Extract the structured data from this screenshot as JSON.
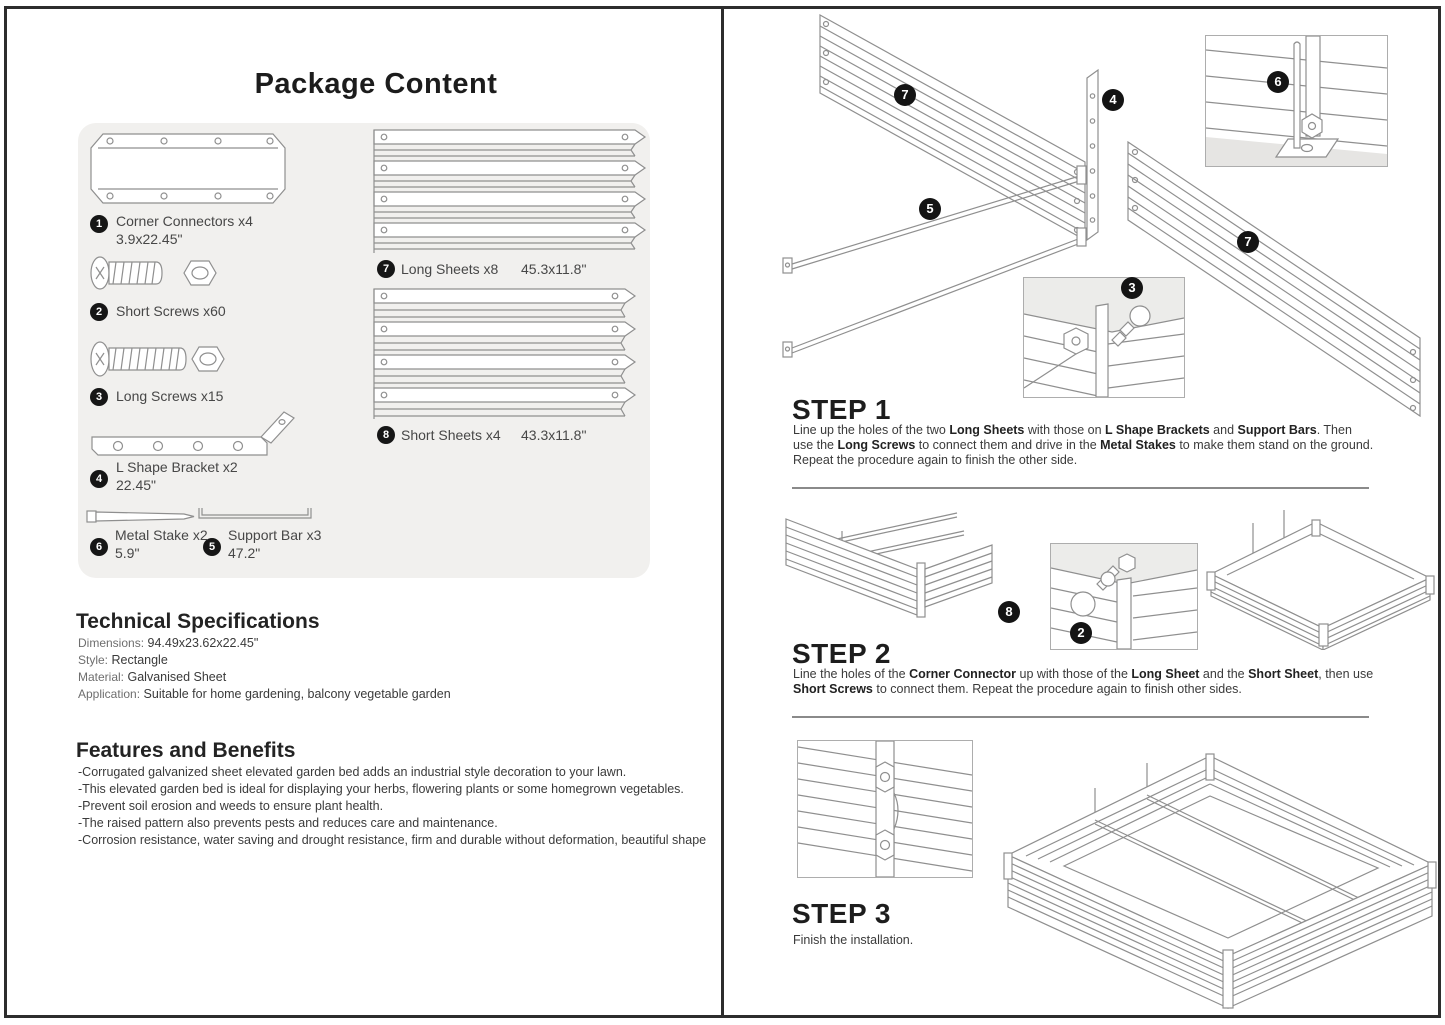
{
  "package": {
    "title": "Package Content",
    "parts": [
      {
        "num": "1",
        "name": "Corner Connectors x4",
        "size": "3.9x22.45\""
      },
      {
        "num": "2",
        "name": "Short Screws x60",
        "size": ""
      },
      {
        "num": "3",
        "name": "Long Screws x15",
        "size": ""
      },
      {
        "num": "4",
        "name": "L Shape Bracket x2",
        "size": "22.45\""
      },
      {
        "num": "6",
        "name": "Metal Stake x2",
        "size": "5.9\""
      },
      {
        "num": "5",
        "name": "Support Bar x3",
        "size": "47.2\""
      },
      {
        "num": "7",
        "name": "Long Sheets x8",
        "size": "45.3x11.8\""
      },
      {
        "num": "8",
        "name": "Short Sheets x4",
        "size": "43.3x11.8\""
      }
    ]
  },
  "specs": {
    "title": "Technical Specifications",
    "items": [
      {
        "label": "Dimensions:",
        "value": "94.49x23.62x22.45\""
      },
      {
        "label": "Style:",
        "value": "Rectangle"
      },
      {
        "label": "Material:",
        "value": "Galvanised Sheet"
      },
      {
        "label": "Application:",
        "value": "Suitable for home gardening, balcony vegetable garden"
      }
    ]
  },
  "features": {
    "title": "Features and Benefits",
    "items": [
      "-Corrugated galvanized sheet elevated garden bed adds an industrial style decoration to your lawn.",
      "-This elevated garden bed is ideal for displaying your herbs, flowering plants or some homegrown vegetables.",
      "-Prevent soil erosion and weeds to ensure plant health.",
      "-The raised pattern also prevents pests and reduces care and maintenance.",
      "-Corrosion resistance, water saving and drought resistance, firm and durable without deformation, beautiful shape"
    ]
  },
  "steps": [
    {
      "title": "STEP 1",
      "segments": [
        {
          "t": "Line up the holes of the two ",
          "b": false
        },
        {
          "t": "Long Sheets",
          "b": true
        },
        {
          "t": " with those on ",
          "b": false
        },
        {
          "t": "L Shape Brackets",
          "b": true
        },
        {
          "t": " and ",
          "b": false
        },
        {
          "t": "Support Bars",
          "b": true
        },
        {
          "t": ". Then use the ",
          "b": false
        },
        {
          "t": "Long Screws",
          "b": true
        },
        {
          "t": " to connect them and drive in the ",
          "b": false
        },
        {
          "t": "Metal Stakes",
          "b": true
        },
        {
          "t": " to make them stand on the ground. Repeat the procedure again to finish the other side.",
          "b": false
        }
      ]
    },
    {
      "title": "STEP 2",
      "segments": [
        {
          "t": "Line the holes of the ",
          "b": false
        },
        {
          "t": "Corner Connector",
          "b": true
        },
        {
          "t": " up with those of the ",
          "b": false
        },
        {
          "t": "Long Sheet",
          "b": true
        },
        {
          "t": " and the ",
          "b": false
        },
        {
          "t": "Short Sheet",
          "b": true
        },
        {
          "t": ", then use ",
          "b": false
        },
        {
          "t": "Short Screws",
          "b": true
        },
        {
          "t": " to connect them. Repeat the procedure again to finish other sides.",
          "b": false
        }
      ]
    },
    {
      "title": "STEP 3",
      "segments": [
        {
          "t": "Finish the installation.",
          "b": false
        }
      ]
    }
  ],
  "diagram": {
    "step1_callouts": [
      "7",
      "4",
      "6",
      "5",
      "3",
      "7"
    ],
    "step2_callouts": [
      "8",
      "2"
    ]
  },
  "colors": {
    "line_art": "#8f8f8f",
    "callout_bg": "#141414",
    "box_bg": "#f1f0ee",
    "border": "#2d2d2d"
  }
}
